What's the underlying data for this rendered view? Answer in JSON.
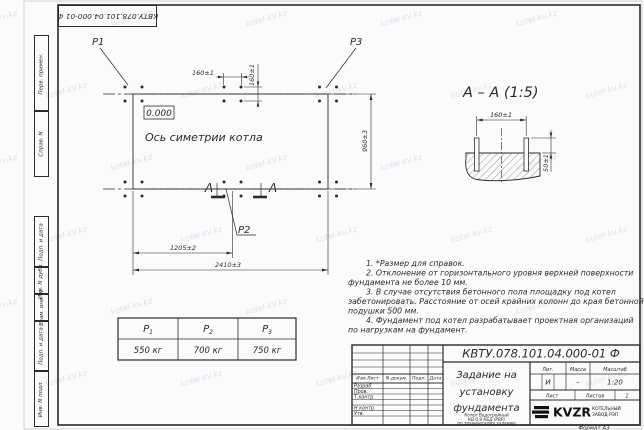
{
  "colors": {
    "ink": "#2b2b2b",
    "watermark": "#b8c0cf"
  },
  "watermark": {
    "text": "kotel-kv.kz"
  },
  "corner_stamp": {
    "doc_number": "КВТУ.078.101.04.000-01 Ф"
  },
  "margin_labels": {
    "items": [
      "Перв. примен.",
      "Справ. N",
      "Подп. и дата",
      "Инв. N дубл.",
      "Взам. инв. N",
      "Подп. и дата",
      "Инв. N подл."
    ]
  },
  "plan": {
    "load_p1": "P1",
    "load_p2": "P2",
    "load_p3": "P3",
    "level_mark": "0.000",
    "axis_label": "Ось симетрии котла",
    "section_letter": "А",
    "dim_bolt_h": "160±1",
    "dim_bolt_v": "160±1",
    "dim_width": "960±3",
    "dim_half_length": "1205±2",
    "dim_length": "2410±3"
  },
  "section_view": {
    "title": "А – А (1:5)",
    "dim_bolts": "160±1",
    "dim_height": "50±1"
  },
  "notes": {
    "lines": [
      "1. *Размер для справок.",
      "2. Отклонение от горизонтального уровня верхней поверхности",
      "фундамента не более 10 мм.",
      "3. В случае отсутствия бетонного пола площадку под котел",
      "забетонировать. Расстояние от осей крайних колонн до края бетонной",
      "подушки 500 мм.",
      "4. Фундамент под котел разрабатывает проектная организаций",
      "по нагрузкам на фундамент."
    ]
  },
  "load_table": {
    "headers": [
      {
        "name": "P",
        "sub": "1"
      },
      {
        "name": "P",
        "sub": "2"
      },
      {
        "name": "P",
        "sub": "3"
      }
    ],
    "values": [
      "550 кг",
      "700 кг",
      "750 кг"
    ]
  },
  "title_block": {
    "doc_number": "КВТУ.078.101.04.000-01 Ф",
    "title_lines": [
      "Задание на",
      "установку",
      "фундамента"
    ],
    "subtitle_lines": [
      "Котел Водогрейный",
      "КВ-0,9 КБД (РВР)",
      "по техническому заданию"
    ],
    "rev_headers": [
      "Изм.Лист",
      "N докум.",
      "Подп.",
      "Дата"
    ],
    "sign_rows": [
      "Разраб.",
      "Пров.",
      "Т.контр.",
      "",
      "Н.контр.",
      "Утв."
    ],
    "lit_header": "Лит.",
    "mass_header": "Масса",
    "scale_header": "Масштаб",
    "lit_value": "И",
    "mass_value": "–",
    "scale_value": "1:20",
    "sheet_label": "Лист",
    "sheets_label": "Листов",
    "sheets_value": "1",
    "logo_text": "KVZR",
    "company_lines": [
      "КОТЕЛЬНЫЙ",
      "ЗАВОД РЭП"
    ],
    "format_label": "Формат А3"
  }
}
